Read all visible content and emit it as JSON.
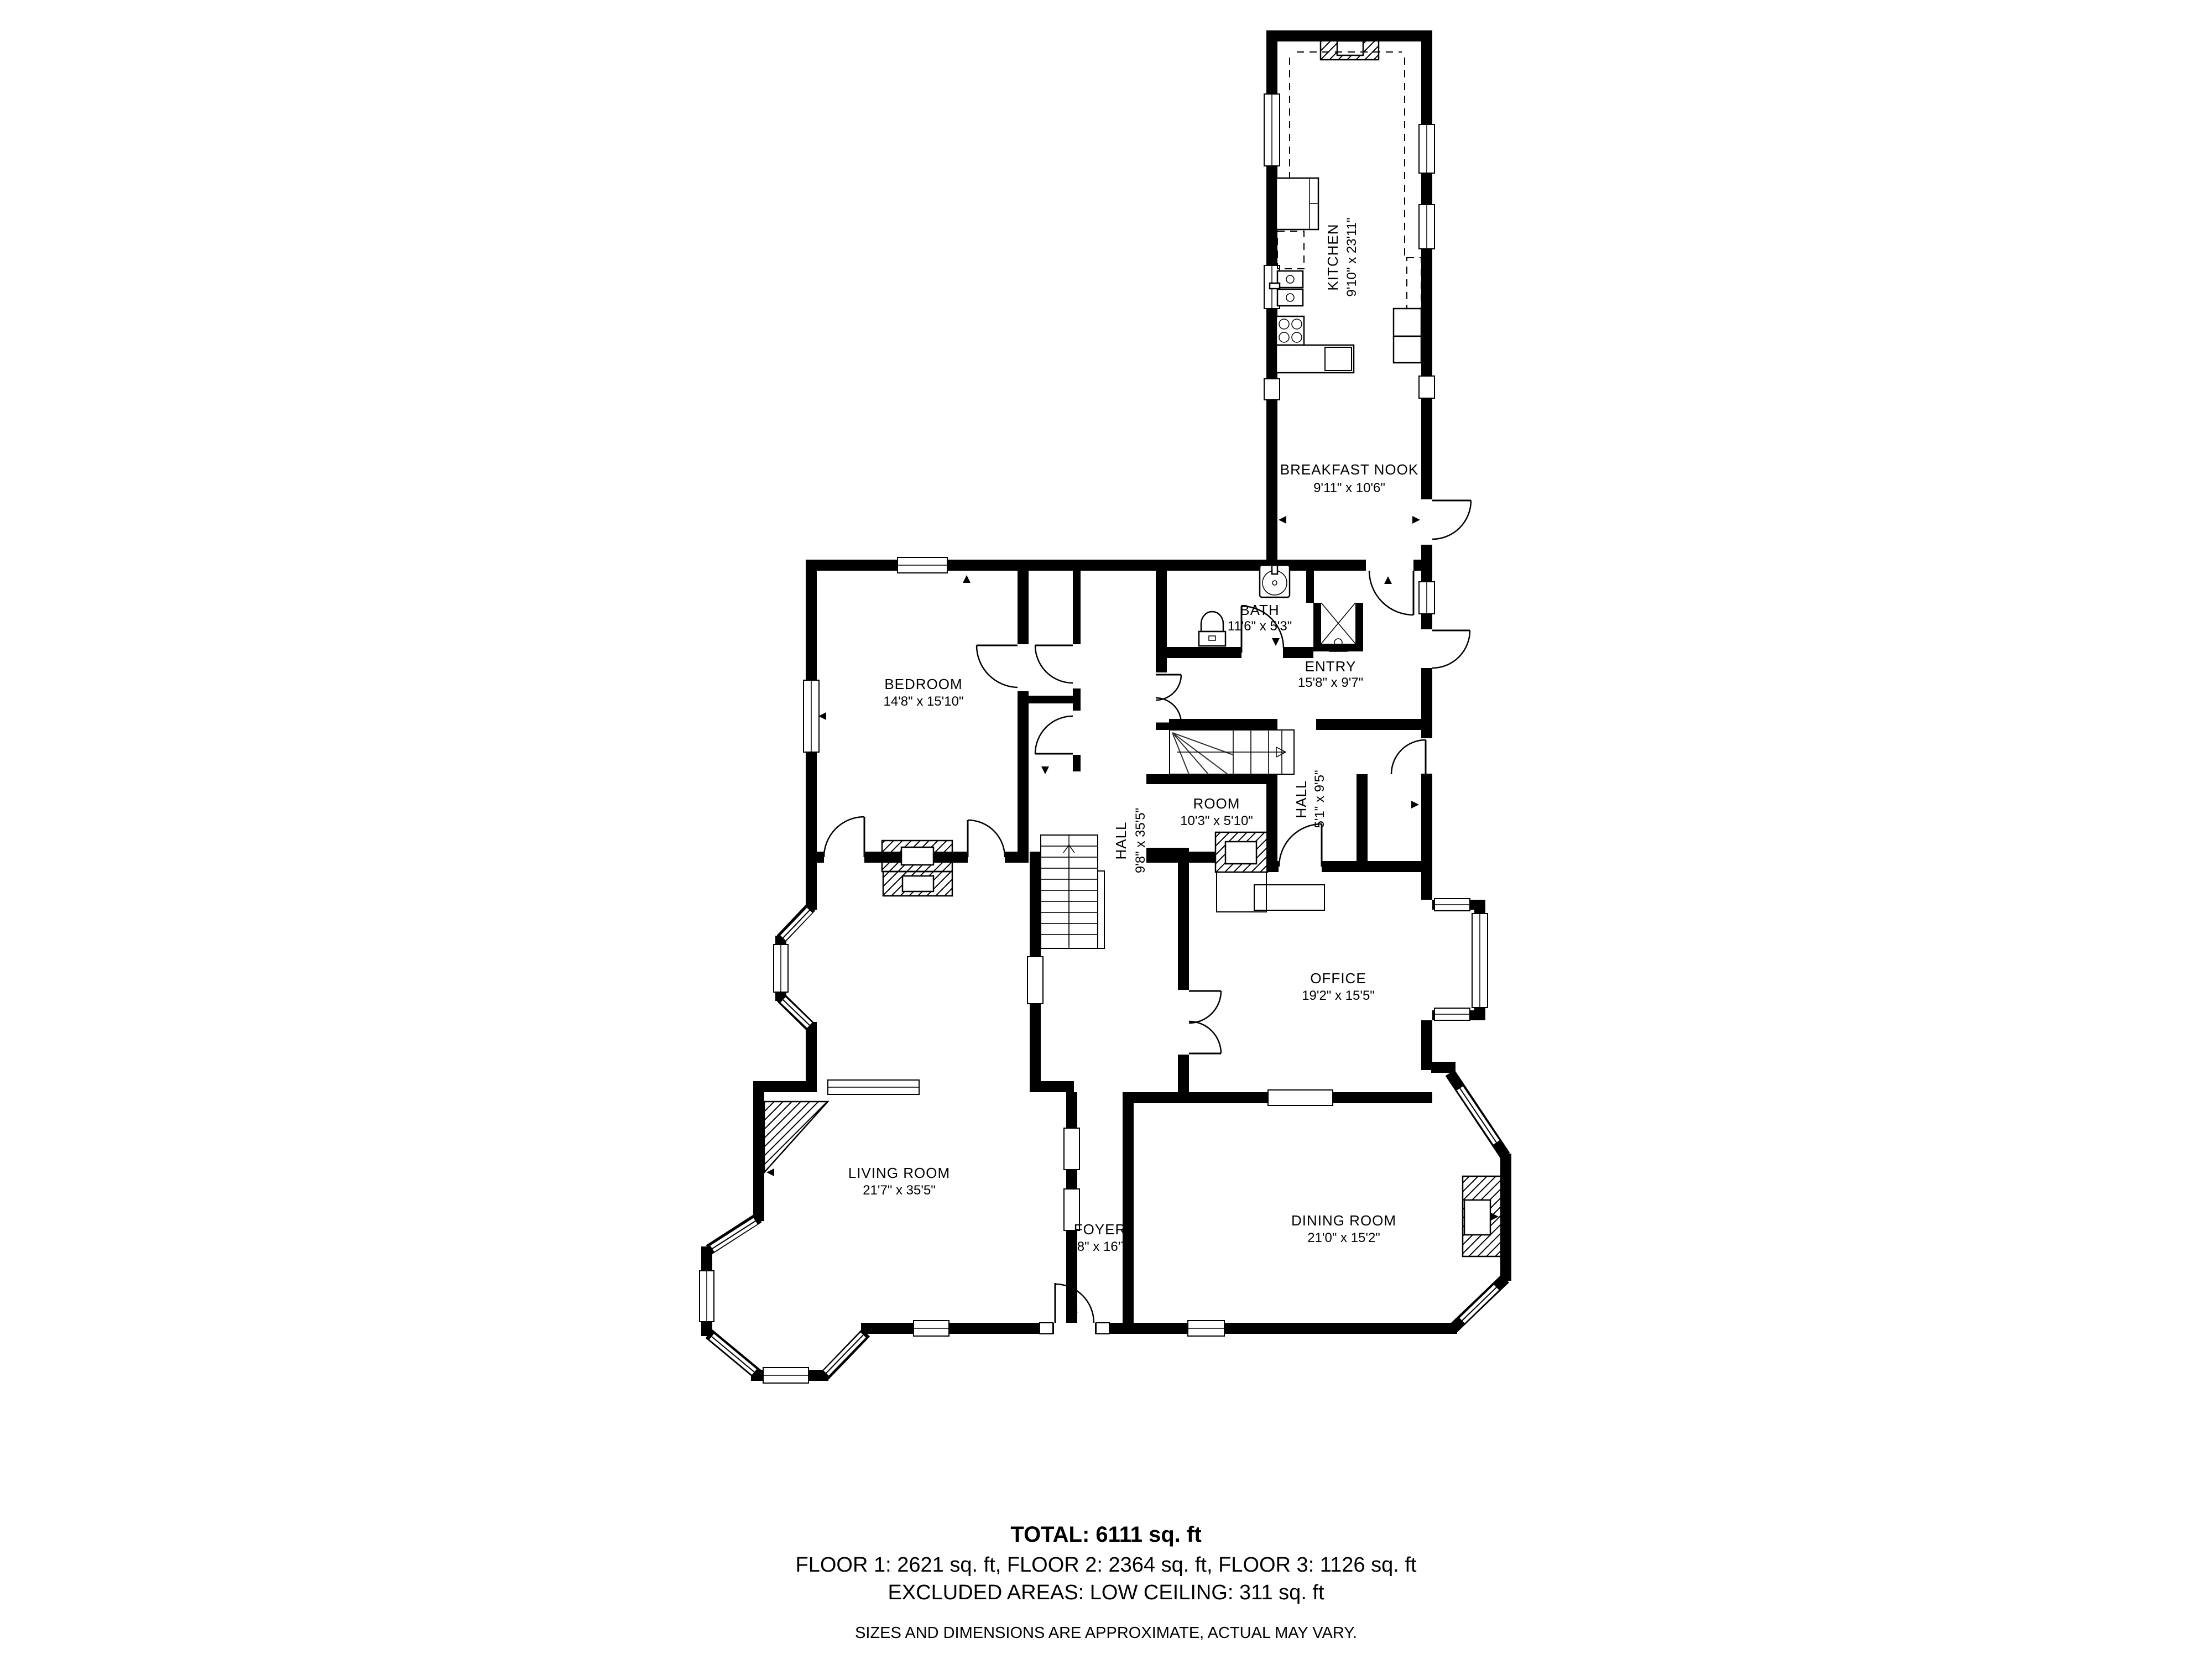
{
  "plan": {
    "title": "House floor plan - Floor 1",
    "rooms": [
      {
        "id": "kitchen",
        "name": "KITCHEN",
        "dims": "9'10\" x 23'11\"",
        "rotated": true
      },
      {
        "id": "breakfast-nook",
        "name": "BREAKFAST NOOK",
        "dims": "9'11\" x 10'6\"",
        "rotated": false
      },
      {
        "id": "bath",
        "name": "BATH",
        "dims": "11'6\" x 5'3\"",
        "rotated": false
      },
      {
        "id": "entry",
        "name": "ENTRY",
        "dims": "15'8\" x 9'7\"",
        "rotated": false
      },
      {
        "id": "bedroom",
        "name": "BEDROOM",
        "dims": "14'8\" x 15'10\"",
        "rotated": false
      },
      {
        "id": "hall",
        "name": "HALL",
        "dims": "9'8\" x 35'5\"",
        "rotated": true
      },
      {
        "id": "room",
        "name": "ROOM",
        "dims": "10'3\" x 5'10\"",
        "rotated": false
      },
      {
        "id": "hall-2",
        "name": "HALL",
        "dims": "5'1\" x 9'5\"",
        "rotated": true
      },
      {
        "id": "office",
        "name": "OFFICE",
        "dims": "19'2\" x 15'5\"",
        "rotated": false
      },
      {
        "id": "living-room",
        "name": "LIVING ROOM",
        "dims": "21'7\" x 35'5\"",
        "rotated": false
      },
      {
        "id": "foyer",
        "name": "FOYER",
        "dims": "9'8\" x 16'7\"",
        "rotated": false
      },
      {
        "id": "dining-room",
        "name": "DINING ROOM",
        "dims": "21'0\" x 15'2\"",
        "rotated": false
      }
    ],
    "footer": {
      "total": "TOTAL: 6111 sq. ft",
      "floors": "FLOOR 1: 2621 sq. ft, FLOOR 2: 2364 sq. ft, FLOOR 3: 1126 sq. ft",
      "excluded": "EXCLUDED AREAS: LOW CEILING: 311 sq. ft",
      "disclaimer": "SIZES AND DIMENSIONS ARE APPROXIMATE, ACTUAL MAY VARY."
    },
    "colors": {
      "wall": "#000000",
      "background": "#ffffff"
    }
  }
}
